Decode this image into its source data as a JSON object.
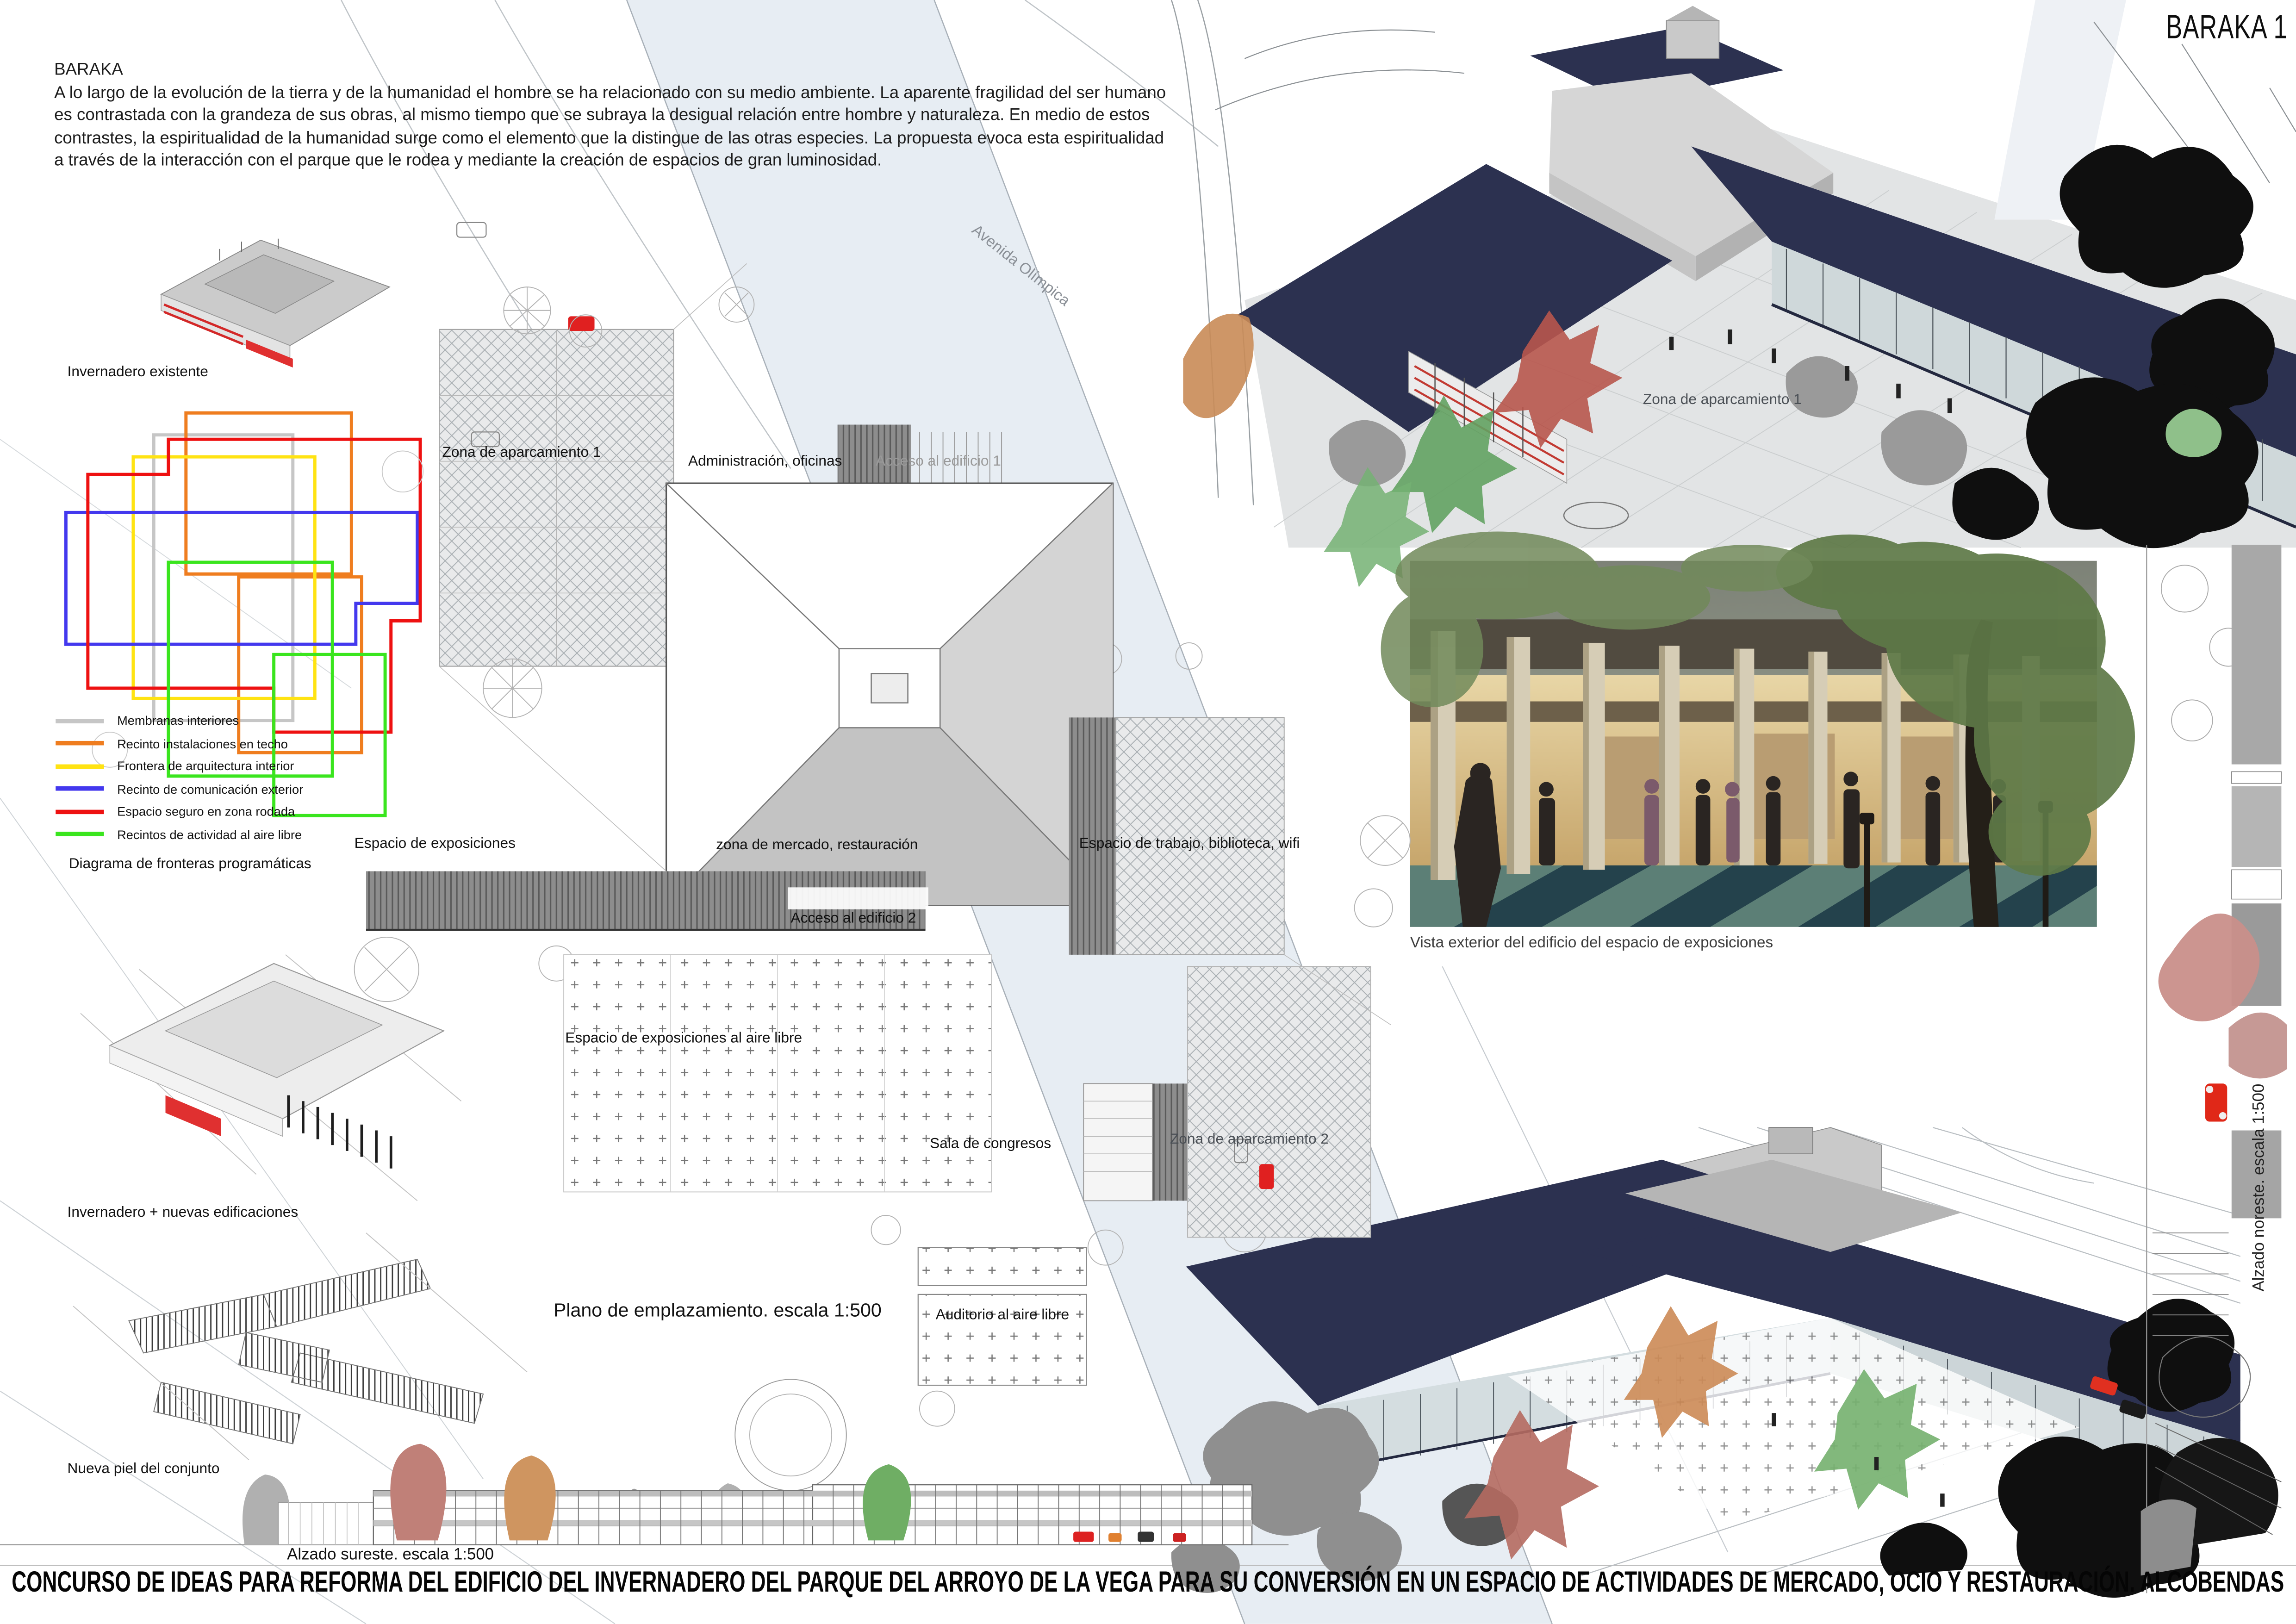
{
  "panel": {
    "code": "BARAKA 1",
    "title": "CONCURSO DE IDEAS PARA REFORMA DEL EDIFICIO DEL INVERNADERO DEL PARQUE DEL ARROYO DE LA VEGA PARA SU CONVERSIÓN EN UN ESPACIO DE ACTIVIDADES DE MERCADO, OCIO Y RESTAURACIÓN. ALCOBENDAS"
  },
  "intro": {
    "title": "BARAKA",
    "body": "A lo largo de la evolución de la tierra y de la humanidad el hombre se ha relacionado con su medio ambiente. La aparente fragilidad del ser humano es contrastada con la grandeza de sus obras, al mismo tiempo que se subraya la desigual relación entre hombre y naturaleza. En medio de estos contrastes, la espiritualidad de la humanidad surge como el elemento que la distingue de las otras especies. La propuesta evoca esta espiritualidad a través de la interacción con el parque que le rodea y mediante la creación de espacios de gran luminosidad."
  },
  "legend": {
    "title": "Diagrama de fronteras programáticas",
    "items": [
      {
        "label": "Membranas interiores",
        "color": "#c6c6c6"
      },
      {
        "label": "Recinto instalaciones en techo",
        "color": "#ef7d1f"
      },
      {
        "label": "Frontera de arquitectura interior",
        "color": "#ffe312"
      },
      {
        "label": "Recinto de comunicación exterior",
        "color": "#4338ee"
      },
      {
        "label": "Espacio seguro en zona rodada",
        "color": "#ee1111"
      },
      {
        "label": "Recintos de actividad al aire libre",
        "color": "#3ae51e"
      }
    ]
  },
  "left_column": {
    "existing": "Invernadero existente",
    "new_buildings": "Invernadero + nuevas edificaciones",
    "new_skin": "Nueva piel del conjunto"
  },
  "plan": {
    "caption": "Plano de emplazamiento. escala 1:500",
    "labels": {
      "parking1": "Zona de aparcamiento 1",
      "admin": "Administración, oficinas",
      "access1": "Acceso al edificio 1",
      "expo": "Espacio de exposiciones",
      "market": "zona de mercado, restauración",
      "work": "Espacio de trabajo, biblioteca, wifi",
      "access2": "Acceso al edificio 2",
      "expo_air": "Espacio de exposiciones al aire libre",
      "congress": "Sala de congresos",
      "parking2": "Zona de aparcamiento 2",
      "auditorium": "Auditorio al aire libre",
      "avenue": "Avenida Olímpica"
    }
  },
  "renders": {
    "top_parking_label": "Zona de aparcamiento 1",
    "photo_caption": "Vista exterior del edificio del espacio de exposiciones"
  },
  "elevations": {
    "southeast": "Alzado sureste. escala 1:500",
    "northeast": "Alzado noreste. escala 1:500"
  },
  "colors": {
    "roof_navy": "#2c3150",
    "road_band": "#e7edf3",
    "accent_red": "#e02020"
  }
}
